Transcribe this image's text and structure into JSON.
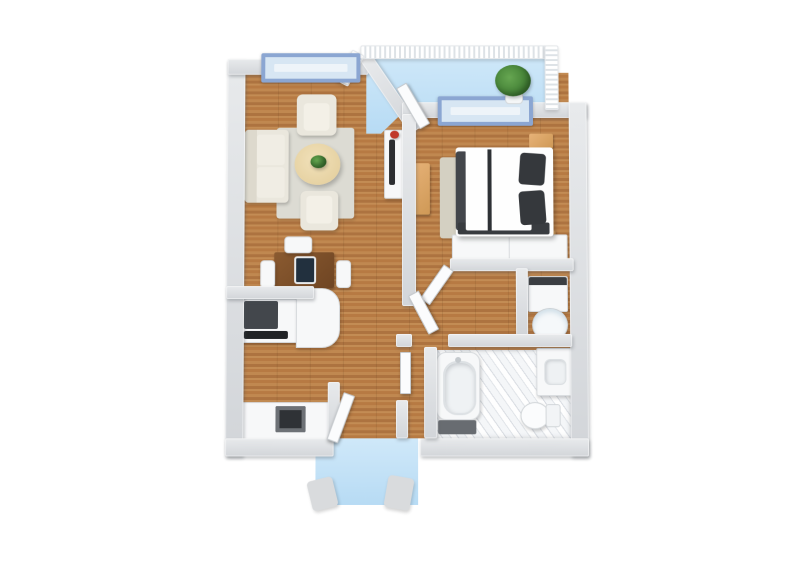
{
  "scene": {
    "kind": "3d-floor-plan-render",
    "view": "top-down isometric",
    "background": "#ffffff",
    "visible_text": "none"
  },
  "colors": {
    "wood_floor": "#b97f46",
    "wood_floor_dark": "#ad7340",
    "wall": "#d5d8dc",
    "wall_top": "#e9ebed",
    "window_frame_blue": "#8ba6d2",
    "window_glass": "#d7e6f3",
    "balcony_floor_blue": "#c3e1f6",
    "porch_floor_blue": "#c3e1f6",
    "railing_white": "#f7f9fa",
    "marble_tile": "#eaecef",
    "living_rug": "#dcdbd3",
    "bedroom_rug": "#d4d0c2",
    "sofa_cream": "#eae7dd",
    "table_beige": "#ead8ad",
    "bed_duvet_dark": "#3a3d42",
    "bed_sheet_white": "#fdfdfd",
    "wood_furniture": "#dfa868",
    "desk_brown": "#7d5128",
    "appliance_dark": "#3a3d41",
    "plant_green": "#4c8a3f",
    "accent_red": "#c0392b"
  },
  "labels": {
    "living_room": "living-room",
    "bedroom": "bedroom",
    "kitchen": "kitchen",
    "bathroom": "bathroom",
    "balcony": "balcony",
    "laundry_closet": "laundry-closet",
    "entry_porch": "entry-porch",
    "sofa": "sofa",
    "bed": "double-bed",
    "bathtub": "bathtub",
    "washer": "washer",
    "desk": "desk-with-monitor",
    "dining_table": "round-table",
    "balcony_plant": "potted-plant",
    "tv": "tv-on-stand",
    "wardrobe": "wardrobe-closet",
    "toilet": "toilet",
    "vanity": "vanity-sink",
    "porch_mat": "entry-porch-floor"
  },
  "rooms": [
    {
      "name": "living-room",
      "furniture": [
        "sofa",
        "armchair",
        "armchair",
        "round-table",
        "table-plant",
        "area-rug",
        "tv-stand",
        "tv",
        "red-vase",
        "window"
      ]
    },
    {
      "name": "bedroom",
      "furniture": [
        "double-bed",
        "pillow",
        "pillow",
        "nightstand",
        "nightstand",
        "dresser",
        "area-rug",
        "wardrobe-closet",
        "window"
      ]
    },
    {
      "name": "balcony",
      "furniture": [
        "railing",
        "potted-plant",
        "balcony-door"
      ]
    },
    {
      "name": "kitchen-dining",
      "furniture": [
        "desk",
        "computer-monitor",
        "chair",
        "chair",
        "chair",
        "upper-counter",
        "range-cooktop",
        "island-counter",
        "sink-counter",
        "sink"
      ]
    },
    {
      "name": "bathroom",
      "furniture": [
        "bathtub",
        "bath-mat",
        "vanity-sink",
        "toilet",
        "marble-floor",
        "bathroom-door"
      ]
    },
    {
      "name": "laundry-closet",
      "furniture": [
        "washer",
        "water-heater-cylinder"
      ]
    },
    {
      "name": "entry-porch",
      "furniture": [
        "porch-floor",
        "planter",
        "planter",
        "front-door"
      ]
    }
  ],
  "windows": [
    "living-room-window",
    "bedroom-window"
  ],
  "doors": [
    "front-door",
    "balcony-door",
    "bedroom-door",
    "hall-door",
    "bathroom-door"
  ]
}
